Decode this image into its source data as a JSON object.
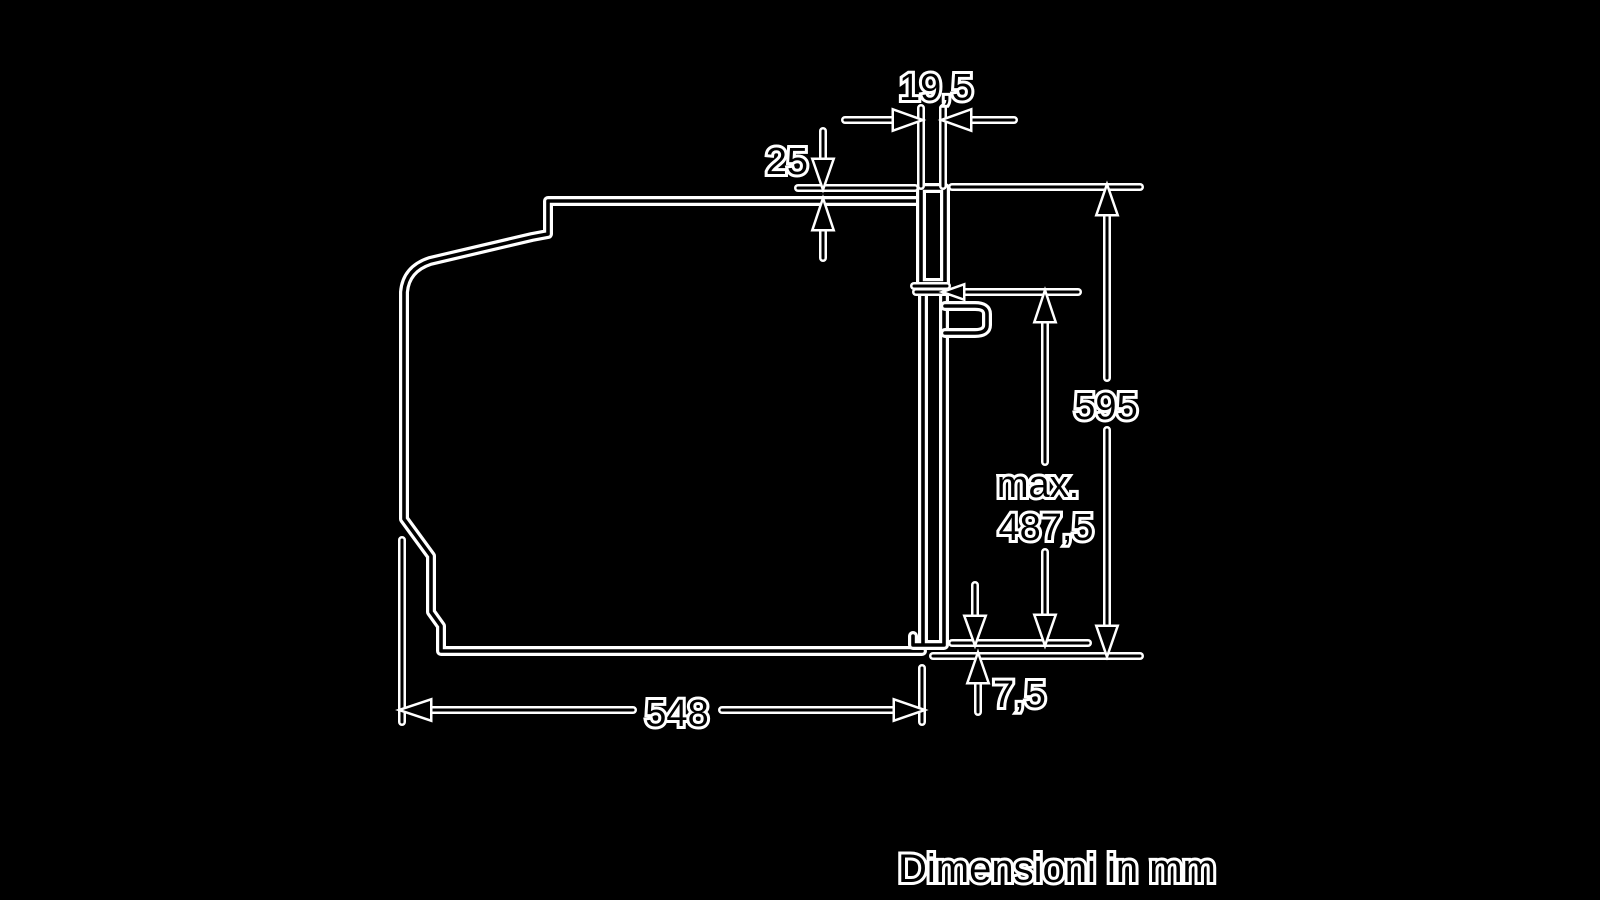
{
  "window": {
    "width": 1600,
    "height": 900,
    "background": "#000000"
  },
  "diagram": {
    "type": "installation-dimension-drawing",
    "subject": "built-in oven side profile with niche dimensions",
    "caption": "Dimensioni in mm",
    "labels": {
      "frame_depth": "19,5",
      "top_gap": "25",
      "height": "595",
      "max_prefix": "max.",
      "max_value": "487,5",
      "bottom_gap": "7,5",
      "depth": "548"
    },
    "colors": {
      "background": "#000000",
      "stroke_halo": "#ffffff",
      "stroke_core": "#000000"
    }
  }
}
